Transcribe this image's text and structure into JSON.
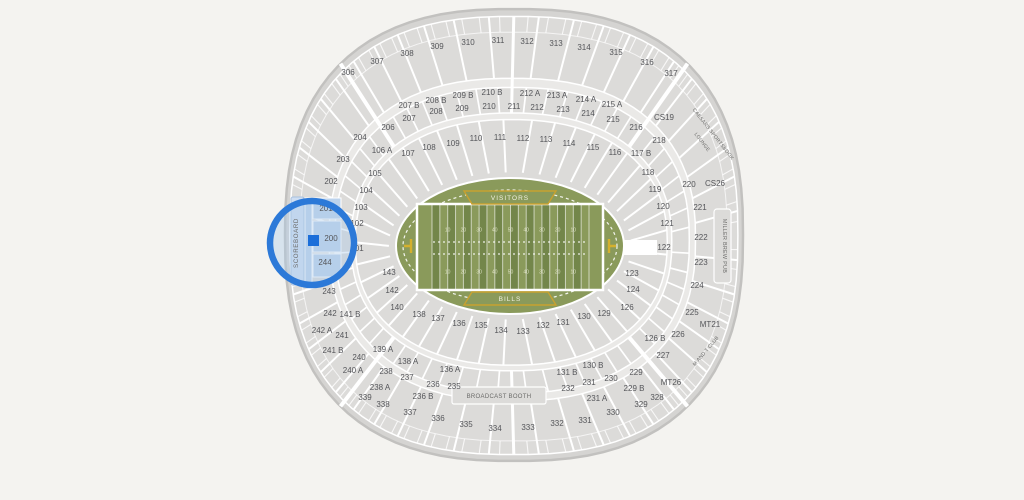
{
  "map_title": "stadium-seat-map",
  "colors": {
    "background": "#f4f3f0",
    "rim": "#d5d4d2",
    "outline": "#c2c1bf",
    "bowl": "#dcdbd9",
    "walkway": "#eae9e7",
    "divider": "#ffffff",
    "section_label": "#55565a",
    "field_green": "#8a9a5b",
    "field_stripe_dark": "#73864a",
    "field_line": "#ffffff",
    "banner_gold": "#c8a12f",
    "banner_text": "#f2f1e2",
    "goalpost_yellow": "#d4b02e",
    "structure_fill": "#dcdbd9",
    "highlight_ring": "#2c79d8",
    "highlight_wash": "rgba(173,202,233,0.40)",
    "highlight_section": "#bdd3ec",
    "highlight_bar": "#cfdef2",
    "selected_marker": "#1b6ed9"
  },
  "field": {
    "visitor_label": "VISITORS",
    "home_label": "BILLS",
    "yard_numbers": [
      "10",
      "20",
      "30",
      "40",
      "50",
      "40",
      "30",
      "20",
      "10"
    ]
  },
  "highlight": {
    "selected_section": "200",
    "cx": 312,
    "cy": 243,
    "r": 42
  },
  "landmarks": [
    {
      "id": "scoreboard",
      "label": "SCOREBOARD",
      "x": 298,
      "y": 243,
      "rotate": -90,
      "size": 6.2,
      "spacing": 0.6
    },
    {
      "id": "broadcast-booth",
      "label": "BROADCAST BOOTH",
      "x": 499,
      "y": 398,
      "rotate": 0,
      "size": 6,
      "spacing": 0.3
    },
    {
      "id": "caesars-sportsbook",
      "label": "CAESARS SPORTSBOOK",
      "x": 712,
      "y": 135,
      "rotate": 52,
      "size": 5,
      "spacing": 0.2
    },
    {
      "id": "caesars-lounge",
      "label": "LOUNGE",
      "x": 701,
      "y": 143,
      "rotate": 52,
      "size": 5,
      "spacing": 0.2
    },
    {
      "id": "miller-brew-pub",
      "label": "MILLER BREW PUB",
      "x": 723,
      "y": 246,
      "rotate": 90,
      "size": 5.4,
      "spacing": 0.3
    },
    {
      "id": "m-and-t-club",
      "label": "M AND T CLUB",
      "x": 707,
      "y": 352,
      "rotate": -50,
      "size": 5,
      "spacing": 0.2
    }
  ],
  "sections": [
    {
      "t": "306",
      "x": 348,
      "y": 72
    },
    {
      "t": "307",
      "x": 377,
      "y": 61
    },
    {
      "t": "308",
      "x": 407,
      "y": 53
    },
    {
      "t": "309",
      "x": 437,
      "y": 46
    },
    {
      "t": "310",
      "x": 468,
      "y": 42
    },
    {
      "t": "311",
      "x": 498,
      "y": 40
    },
    {
      "t": "312",
      "x": 527,
      "y": 41
    },
    {
      "t": "313",
      "x": 556,
      "y": 43
    },
    {
      "t": "314",
      "x": 584,
      "y": 47
    },
    {
      "t": "315",
      "x": 616,
      "y": 52
    },
    {
      "t": "316",
      "x": 647,
      "y": 62
    },
    {
      "t": "317",
      "x": 671,
      "y": 73
    },
    {
      "t": "207 B",
      "x": 409,
      "y": 105
    },
    {
      "t": "208 B",
      "x": 436,
      "y": 100
    },
    {
      "t": "209 B",
      "x": 463,
      "y": 95
    },
    {
      "t": "210 B",
      "x": 492,
      "y": 92
    },
    {
      "t": "212 A",
      "x": 530,
      "y": 93
    },
    {
      "t": "213 A",
      "x": 557,
      "y": 95
    },
    {
      "t": "214 A",
      "x": 586,
      "y": 99
    },
    {
      "t": "215 A",
      "x": 612,
      "y": 104
    },
    {
      "t": "206",
      "x": 388,
      "y": 127
    },
    {
      "t": "207",
      "x": 409,
      "y": 118
    },
    {
      "t": "208",
      "x": 436,
      "y": 111
    },
    {
      "t": "209",
      "x": 462,
      "y": 108
    },
    {
      "t": "210",
      "x": 489,
      "y": 106
    },
    {
      "t": "211",
      "x": 514,
      "y": 106
    },
    {
      "t": "212",
      "x": 537,
      "y": 107
    },
    {
      "t": "213",
      "x": 563,
      "y": 109
    },
    {
      "t": "214",
      "x": 588,
      "y": 113
    },
    {
      "t": "215",
      "x": 613,
      "y": 119
    },
    {
      "t": "216",
      "x": 636,
      "y": 127
    },
    {
      "t": "CS19",
      "x": 664,
      "y": 117
    },
    {
      "t": "218",
      "x": 659,
      "y": 140
    },
    {
      "t": "204",
      "x": 360,
      "y": 137
    },
    {
      "t": "203",
      "x": 343,
      "y": 159
    },
    {
      "t": "202",
      "x": 331,
      "y": 181
    },
    {
      "t": "201",
      "x": 326,
      "y": 208
    },
    {
      "t": "200",
      "x": 331,
      "y": 238
    },
    {
      "t": "244",
      "x": 325,
      "y": 262
    },
    {
      "t": "243",
      "x": 329,
      "y": 291
    },
    {
      "t": "242",
      "x": 330,
      "y": 313
    },
    {
      "t": "242 A",
      "x": 322,
      "y": 330
    },
    {
      "t": "241",
      "x": 342,
      "y": 335
    },
    {
      "t": "241 B",
      "x": 333,
      "y": 350
    },
    {
      "t": "240",
      "x": 359,
      "y": 357
    },
    {
      "t": "240 A",
      "x": 353,
      "y": 370
    },
    {
      "t": "106 A",
      "x": 382,
      "y": 150
    },
    {
      "t": "107",
      "x": 408,
      "y": 153
    },
    {
      "t": "108",
      "x": 429,
      "y": 147
    },
    {
      "t": "109",
      "x": 453,
      "y": 143
    },
    {
      "t": "110",
      "x": 476,
      "y": 138
    },
    {
      "t": "111",
      "x": 500,
      "y": 137
    },
    {
      "t": "112",
      "x": 523,
      "y": 138
    },
    {
      "t": "113",
      "x": 546,
      "y": 139
    },
    {
      "t": "114",
      "x": 569,
      "y": 143
    },
    {
      "t": "115",
      "x": 593,
      "y": 147
    },
    {
      "t": "116",
      "x": 615,
      "y": 152
    },
    {
      "t": "117 B",
      "x": 641,
      "y": 153
    },
    {
      "t": "105",
      "x": 375,
      "y": 173
    },
    {
      "t": "104",
      "x": 366,
      "y": 190
    },
    {
      "t": "103",
      "x": 361,
      "y": 207
    },
    {
      "t": "102",
      "x": 357,
      "y": 223
    },
    {
      "t": "101",
      "x": 357,
      "y": 248
    },
    {
      "t": "143",
      "x": 389,
      "y": 272
    },
    {
      "t": "142",
      "x": 392,
      "y": 290
    },
    {
      "t": "141 B",
      "x": 350,
      "y": 314
    },
    {
      "t": "140",
      "x": 397,
      "y": 307
    },
    {
      "t": "139 A",
      "x": 383,
      "y": 349
    },
    {
      "t": "138 A",
      "x": 408,
      "y": 361
    },
    {
      "t": "138",
      "x": 419,
      "y": 314
    },
    {
      "t": "137",
      "x": 438,
      "y": 318
    },
    {
      "t": "136",
      "x": 459,
      "y": 323
    },
    {
      "t": "135",
      "x": 481,
      "y": 325
    },
    {
      "t": "134",
      "x": 501,
      "y": 330
    },
    {
      "t": "133",
      "x": 523,
      "y": 331
    },
    {
      "t": "132",
      "x": 543,
      "y": 325
    },
    {
      "t": "131",
      "x": 563,
      "y": 322
    },
    {
      "t": "130",
      "x": 584,
      "y": 316
    },
    {
      "t": "129",
      "x": 604,
      "y": 313
    },
    {
      "t": "126",
      "x": 627,
      "y": 307
    },
    {
      "t": "126 B",
      "x": 655,
      "y": 338
    },
    {
      "t": "136 A",
      "x": 450,
      "y": 369
    },
    {
      "t": "131 B",
      "x": 567,
      "y": 372
    },
    {
      "t": "130 B",
      "x": 593,
      "y": 365
    },
    {
      "t": "118",
      "x": 648,
      "y": 172
    },
    {
      "t": "119",
      "x": 655,
      "y": 189
    },
    {
      "t": "120",
      "x": 663,
      "y": 206
    },
    {
      "t": "121",
      "x": 667,
      "y": 223
    },
    {
      "t": "122",
      "x": 664,
      "y": 247
    },
    {
      "t": "123",
      "x": 632,
      "y": 273
    },
    {
      "t": "124",
      "x": 633,
      "y": 289
    },
    {
      "t": "220",
      "x": 689,
      "y": 184
    },
    {
      "t": "CS26",
      "x": 715,
      "y": 183
    },
    {
      "t": "221",
      "x": 700,
      "y": 207
    },
    {
      "t": "222",
      "x": 701,
      "y": 237
    },
    {
      "t": "223",
      "x": 701,
      "y": 262
    },
    {
      "t": "224",
      "x": 697,
      "y": 285
    },
    {
      "t": "225",
      "x": 692,
      "y": 312
    },
    {
      "t": "226",
      "x": 678,
      "y": 334
    },
    {
      "t": "227",
      "x": 663,
      "y": 355
    },
    {
      "t": "MT21",
      "x": 710,
      "y": 324
    },
    {
      "t": "229",
      "x": 636,
      "y": 372
    },
    {
      "t": "229 B",
      "x": 634,
      "y": 388
    },
    {
      "t": "230",
      "x": 611,
      "y": 378
    },
    {
      "t": "231",
      "x": 589,
      "y": 382
    },
    {
      "t": "231 A",
      "x": 597,
      "y": 398
    },
    {
      "t": "232",
      "x": 568,
      "y": 388
    },
    {
      "t": "235",
      "x": 454,
      "y": 386
    },
    {
      "t": "236",
      "x": 433,
      "y": 384
    },
    {
      "t": "236 B",
      "x": 423,
      "y": 396
    },
    {
      "t": "237",
      "x": 407,
      "y": 377
    },
    {
      "t": "238",
      "x": 386,
      "y": 371
    },
    {
      "t": "238 A",
      "x": 380,
      "y": 387
    },
    {
      "t": "MT26",
      "x": 671,
      "y": 382
    },
    {
      "t": "328",
      "x": 657,
      "y": 397
    },
    {
      "t": "329",
      "x": 641,
      "y": 404
    },
    {
      "t": "330",
      "x": 613,
      "y": 412
    },
    {
      "t": "331",
      "x": 585,
      "y": 420
    },
    {
      "t": "332",
      "x": 557,
      "y": 423
    },
    {
      "t": "333",
      "x": 528,
      "y": 427
    },
    {
      "t": "334",
      "x": 495,
      "y": 428
    },
    {
      "t": "335",
      "x": 466,
      "y": 424
    },
    {
      "t": "336",
      "x": 438,
      "y": 418
    },
    {
      "t": "337",
      "x": 410,
      "y": 412
    },
    {
      "t": "338",
      "x": 383,
      "y": 404
    },
    {
      "t": "339",
      "x": 365,
      "y": 397
    }
  ]
}
